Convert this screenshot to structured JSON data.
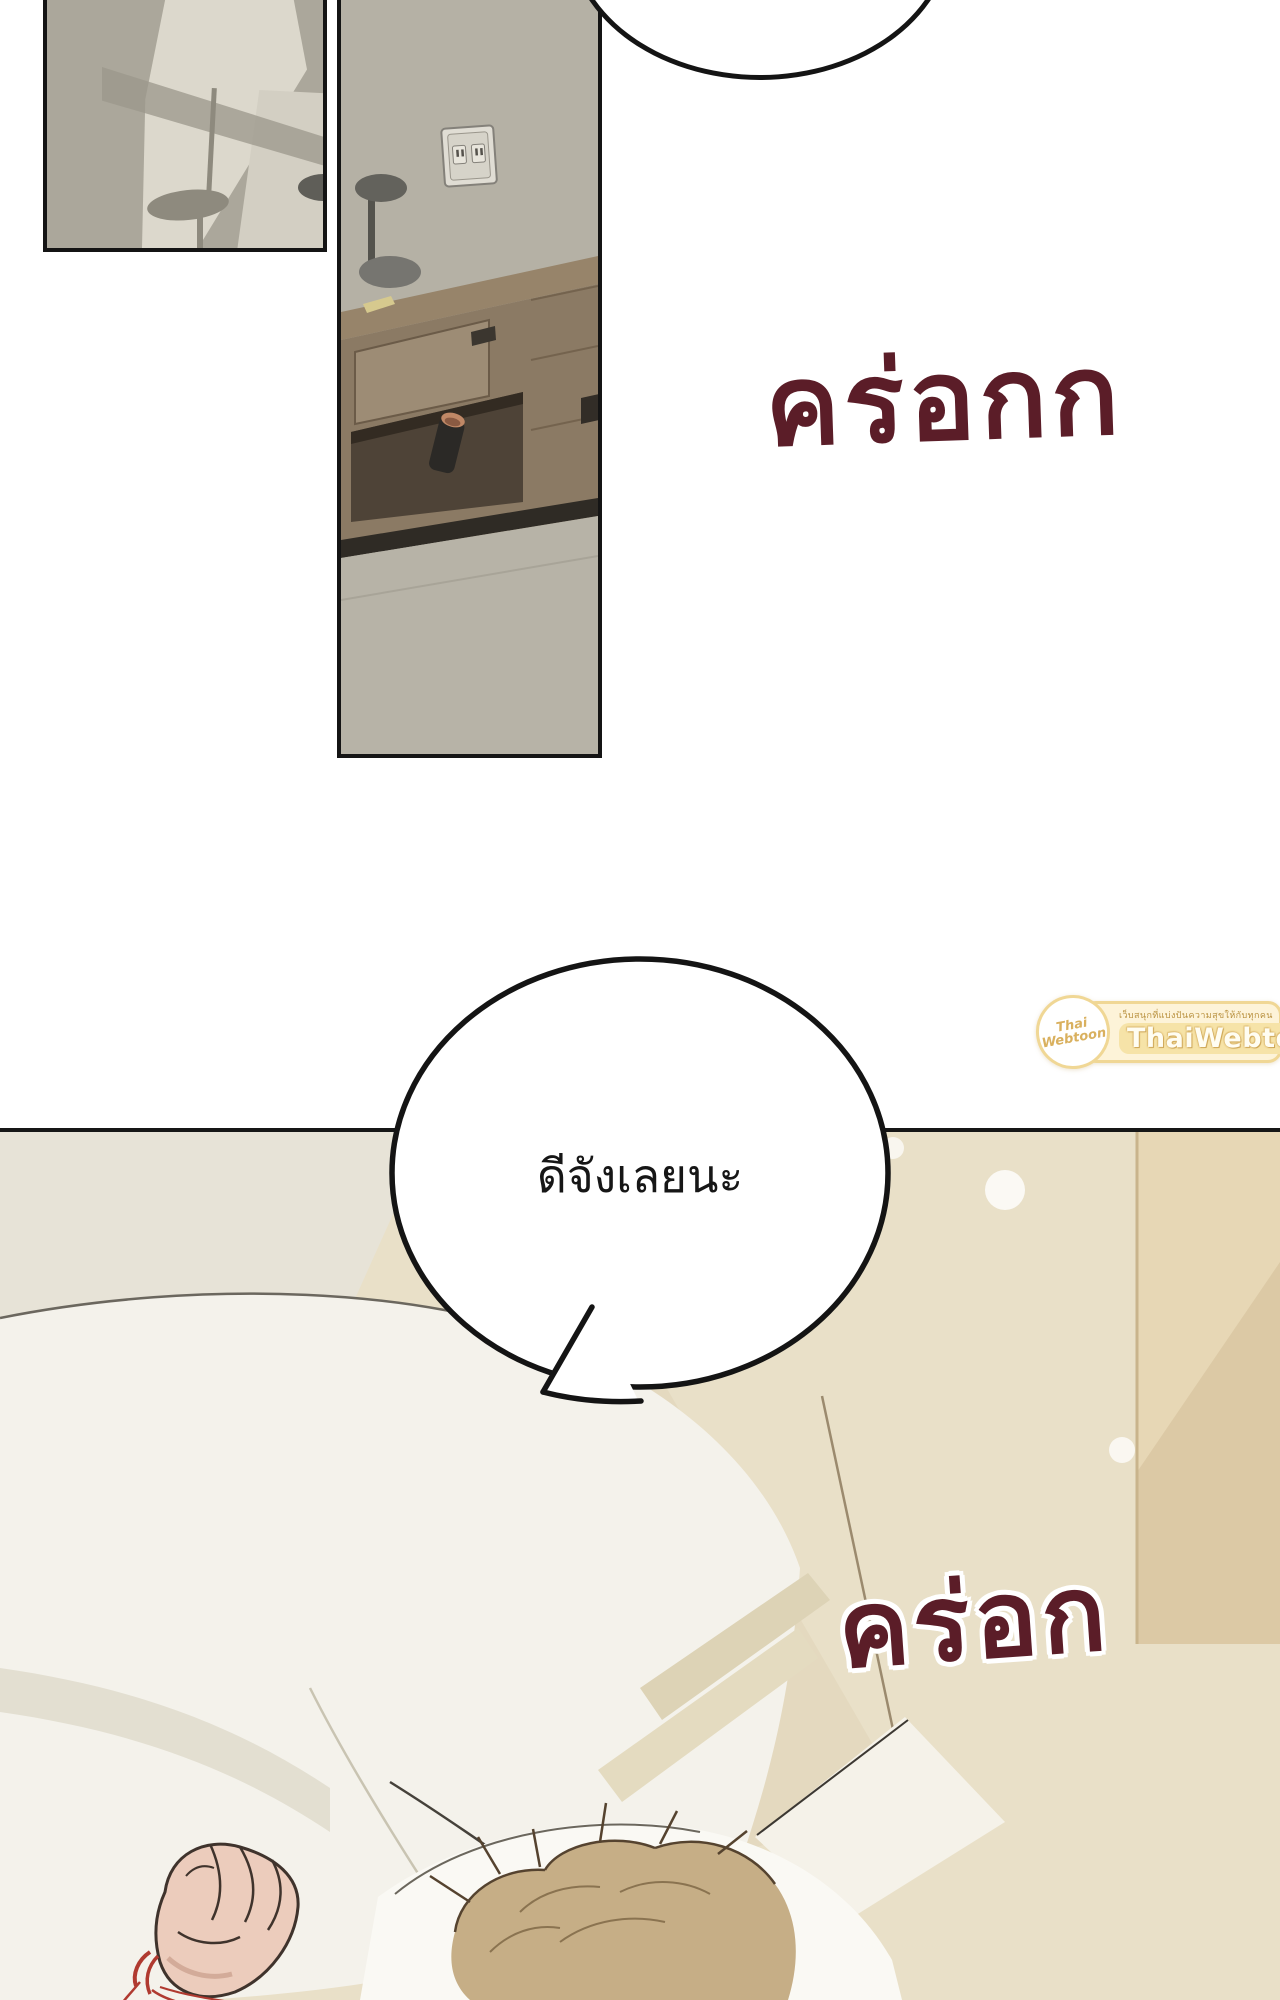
{
  "page": {
    "width": 1280,
    "height": 2000,
    "background": "#ffffff",
    "type": "webtoon-comic-page"
  },
  "sfx_top": {
    "text": "คร่อกก",
    "color": "#5b1d28"
  },
  "speech_bubble": {
    "text": "ดีจังเลยนะ",
    "fill": "#ffffff",
    "stroke": "#141414"
  },
  "sfx_bottom": {
    "text": "คร่อก",
    "color": "#5b1d28",
    "outline_color": "#ffffff"
  },
  "watermark": {
    "tagline": "เว็บสนุกที่แบ่งปันความสุขให้กับทุกคน",
    "brand": "ThaiWebtoon",
    "logo_top": "Thai",
    "logo_bottom": "Webtoon",
    "band_color": "#fdf3d8",
    "border_color": "#f0d795",
    "brand_text_color": "#fffdf2",
    "tagline_color": "#b9913f"
  },
  "colors": {
    "panel_border": "#141414",
    "sfx_maroon": "#5b1d28",
    "wall_gray": "#b5b1a5",
    "wall_gray_light": "#dcd8cc",
    "bottom_beige": "#e9e0c8",
    "right_strip_tan": "#dcc9a5",
    "wood": "#8d7c66",
    "blanket_white": "#f5f3ec",
    "pillow_white": "#faf9f4",
    "hair_sandy": "#c6ae86",
    "skin": "#ecccbc",
    "string_red": "#b03a30"
  }
}
